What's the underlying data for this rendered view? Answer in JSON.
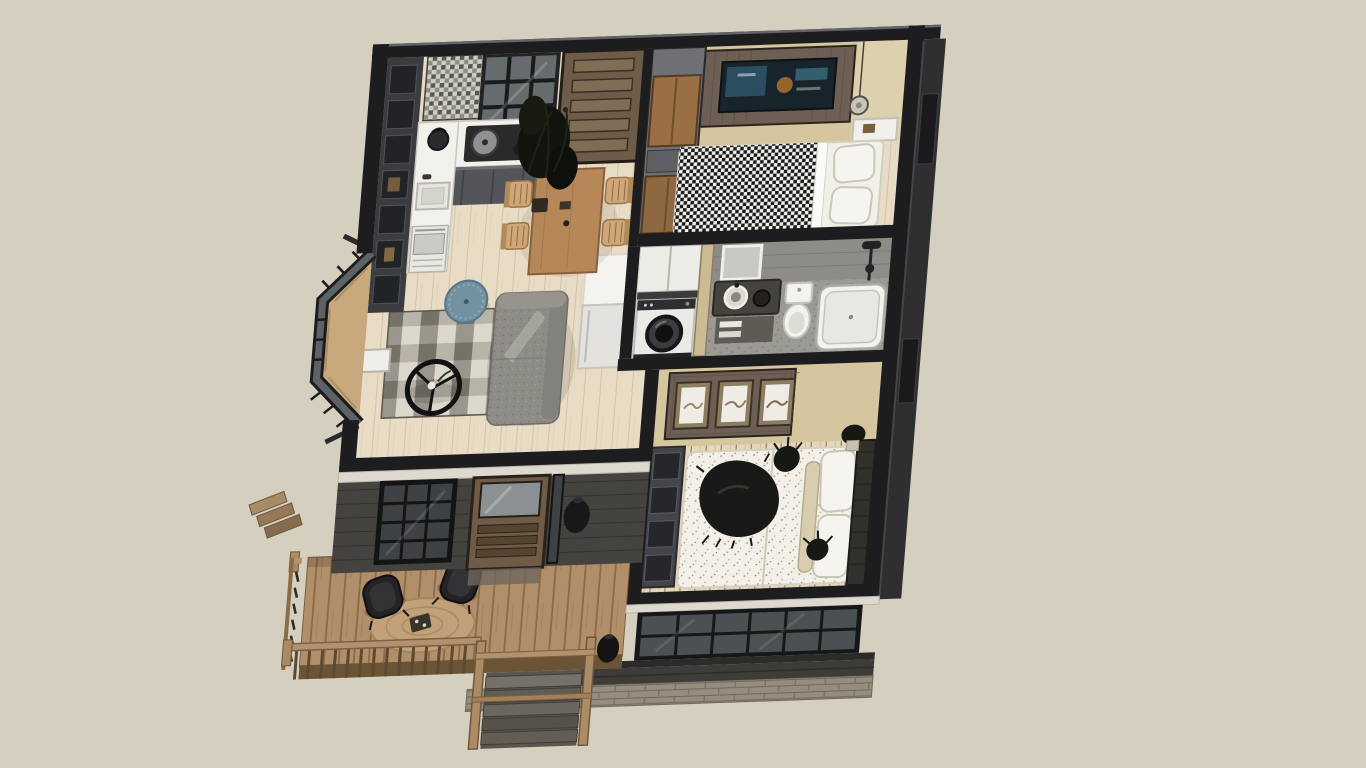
{
  "scene": {
    "type": "3d-floorplan-render",
    "style": "sketchup-cutaway-birdseye",
    "building": "one-storey-cottage-with-deck"
  },
  "palette": {
    "background": "#d5cfc0",
    "wall-cut": "#1d1d1f",
    "wall-tan": "#d6c69e",
    "exterior-siding": "#454340",
    "exterior-right": "#2f2f31",
    "counter-white": "#f2f0ea",
    "fixture-white": "#f3f2ee",
    "wood-panel": "#6d5f53",
    "pouf-blue": "#7291a1",
    "trim-light": "#ddd9ce",
    "floor-wood": "#e9dcc6",
    "deck-wood": "#b3906c",
    "stone": "#968d7e"
  },
  "rooms": [
    {
      "name": "kitchen",
      "furniture": [
        "wall-shelving-cubbies",
        "mosaic-tile-floor",
        "l-shaped-counter",
        "cooktop-with-pot",
        "kettle",
        "sink",
        "oven",
        "glass-partition"
      ]
    },
    {
      "name": "dining",
      "furniture": [
        "wood-table",
        "four-woven-chairs",
        "tall-plant",
        "back-door-five-panel"
      ]
    },
    {
      "name": "bedroom-top",
      "furniture": [
        "wardrobe-column",
        "tv-wood-accent-panel",
        "bed-bw-pattern-blanket",
        "white-pillows",
        "pendant-lamp",
        "nightstand"
      ]
    },
    {
      "name": "bathroom",
      "furniture": [
        "mirror",
        "dark-vanity",
        "vessel-sinks",
        "toilet",
        "bathtub",
        "shower-set",
        "towel-shelf"
      ]
    },
    {
      "name": "laundry",
      "furniture": [
        "upper-cabinets",
        "front-load-washer"
      ]
    },
    {
      "name": "hallway",
      "furniture": [
        "tall-white-fridge-cabinet"
      ]
    },
    {
      "name": "living",
      "furniture": [
        "chaise-sofa-gray",
        "checkered-rug",
        "round-black-coffee-table",
        "blue-pouf",
        "bay-window-seat",
        "white-side-table",
        "front-door-glass-slats",
        "south-window"
      ]
    },
    {
      "name": "bedroom-bottom",
      "furniture": [
        "gallery-panel-three-frames",
        "bed-speckled-duvet",
        "dark-throw-blanket",
        "wall-shelf-unit",
        "slat-headboard",
        "picture-window-wall",
        "plants"
      ]
    },
    {
      "name": "deck",
      "furniture": [
        "two-black-lounge-chairs",
        "round-jute-rug",
        "serving-tray",
        "wood-railing",
        "main-stairs",
        "side-steps",
        "planter-vases",
        "stone-foundation"
      ]
    }
  ]
}
